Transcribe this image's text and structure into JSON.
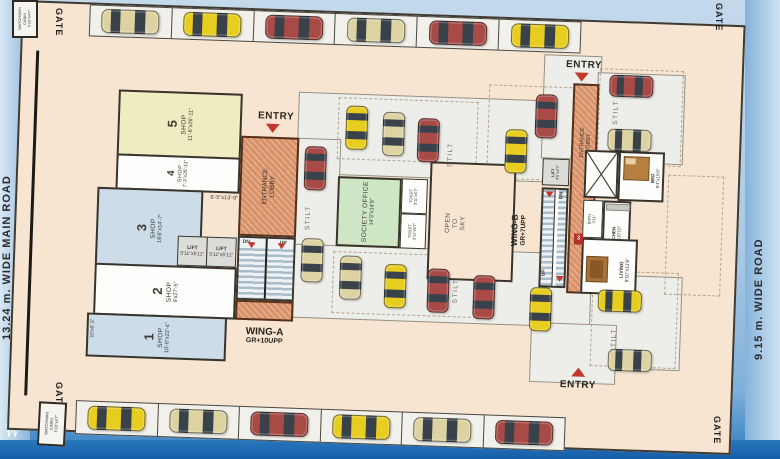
{
  "plan": {
    "roads": {
      "left": "13.24 m. WIDE MAIN ROAD",
      "right": "9.15 m. WIDE ROAD"
    },
    "gates": {
      "top_left": "GATE",
      "top_right": "GATE",
      "bottom_left": "GATE",
      "bottom_right": "GATE"
    },
    "watchman_cabin": {
      "line1": "WATCHMAN",
      "line2": "CABIN",
      "dim": "5'10\"x4'7\""
    },
    "entries": {
      "wing_a": "ENTRY",
      "wing_b_top": "ENTRY",
      "wing_b_bottom": "ENTRY"
    },
    "lobby": {
      "line1": "ENTRANCE",
      "line2": "LOBBY"
    },
    "wing_a": {
      "name": "WING-A",
      "floors": "GR+10UPP",
      "lift1": {
        "label": "LIFT",
        "dim": "5'11\"x5'11\""
      },
      "lift2": {
        "label": "LIFT",
        "dim": "5'11\"x5'11\""
      },
      "stairs": {
        "dn": "DN",
        "up": "UP"
      },
      "corridor_dim": "6'-5\"x13'-9\""
    },
    "wing_b": {
      "name": "WING-B",
      "floors": "GR+7UPP",
      "lift": {
        "label": "LIFT",
        "dim": "4'5\"x4'7\""
      },
      "stairs": {
        "dn": "DN",
        "up": "UP"
      }
    },
    "shops": [
      {
        "no": "1",
        "type": "SHOP",
        "dim": "10'-6\"x22'-4\"",
        "extra_dim": "10'x6'-3\""
      },
      {
        "no": "2",
        "type": "SHOP",
        "dim": "9'x27'-5\""
      },
      {
        "no": "3",
        "type": "SHOP",
        "dim": "18'6\"x14'-7\""
      },
      {
        "no": "4",
        "type": "SHOP",
        "dim": "7'-3\"x26'-11\""
      },
      {
        "no": "5",
        "type": "SHOP",
        "dim": "11'-6\"x26'-11\""
      }
    ],
    "rooms": {
      "society_office": {
        "name": "SOCIETY OFFICE",
        "dim": "14'3\"x14'9\""
      },
      "toilet1": {
        "name": "TOILET",
        "dim": "3'11\"x6'7\""
      },
      "toilet2": {
        "name": "TOILET",
        "dim": "3'11\"x6'7\""
      },
      "open_to_sky": {
        "l1": "OPEN",
        "l2": "TO",
        "l3": "SKY"
      },
      "bed": {
        "name": "BED",
        "dim": "9'4\"x10'6\""
      },
      "kitchen": {
        "name": "KITCHEN",
        "dim": "6'6\"x10'10\""
      },
      "bath": {
        "name": "BATH",
        "dim": "3'11\""
      },
      "living": {
        "name": "LIVING",
        "dim": "9'10\"x11'6\""
      },
      "flat_no": "3"
    },
    "stilt_label": "STILT",
    "watermark": "W"
  },
  "colors": {
    "car_yellow": "#e6cd1f",
    "car_beige": "#ddd3a2",
    "car_red": "#a84a45",
    "car_window": "#39414a",
    "lobby_orange": "#d99267",
    "office_green": "#cfe6c5",
    "shop_blue": "#ccdde9",
    "shop_yellow": "#f0ecc2",
    "road_blue": "#8cb6dc"
  },
  "cars": {
    "street_top": [
      "beige",
      "yellow",
      "red",
      "beige",
      "red",
      "yellow"
    ],
    "street_bottom": [
      "yellow",
      "beige",
      "red",
      "yellow",
      "beige",
      "red"
    ],
    "interior": [
      {
        "x": 326,
        "y": 92,
        "o": "v",
        "c": "yellow"
      },
      {
        "x": 363,
        "y": 97,
        "o": "v",
        "c": "beige"
      },
      {
        "x": 398,
        "y": 102,
        "o": "v",
        "c": "red"
      },
      {
        "x": 486,
        "y": 110,
        "o": "v",
        "c": "yellow"
      },
      {
        "x": 515,
        "y": 74,
        "o": "v",
        "c": "red"
      },
      {
        "x": 588,
        "y": 52,
        "o": "h",
        "c": "red"
      },
      {
        "x": 588,
        "y": 106,
        "o": "h",
        "c": "beige"
      },
      {
        "x": 286,
        "y": 134,
        "o": "v",
        "c": "red"
      },
      {
        "x": 286,
        "y": 226,
        "o": "v",
        "c": "beige"
      },
      {
        "x": 325,
        "y": 242,
        "o": "v",
        "c": "beige"
      },
      {
        "x": 370,
        "y": 249,
        "o": "v",
        "c": "yellow"
      },
      {
        "x": 413,
        "y": 252,
        "o": "v",
        "c": "red"
      },
      {
        "x": 459,
        "y": 257,
        "o": "v",
        "c": "red"
      },
      {
        "x": 516,
        "y": 267,
        "o": "v",
        "c": "yellow"
      },
      {
        "x": 584,
        "y": 267,
        "o": "h",
        "c": "yellow"
      },
      {
        "x": 596,
        "y": 326,
        "o": "h",
        "c": "beige"
      }
    ]
  }
}
